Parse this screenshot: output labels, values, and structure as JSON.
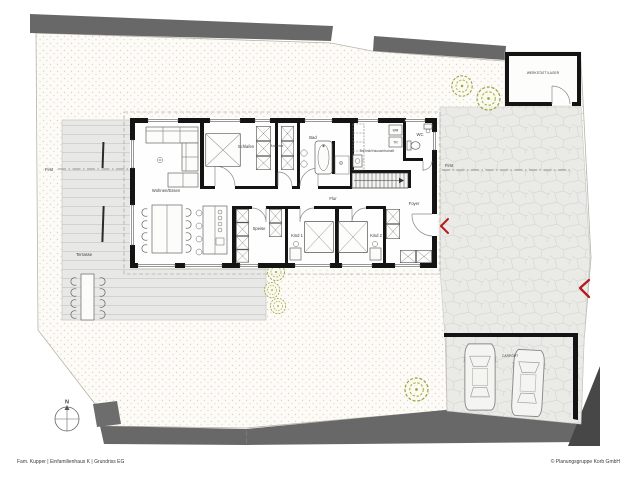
{
  "meta": {
    "footer_left": "Fam. Kupper | Einfamilienhaus K | Grundriss EG",
    "footer_right": "© Planungsgruppe Korb GmbH"
  },
  "site": {
    "compass": "N",
    "ridge_left": "First",
    "ridge_right": "First",
    "terrace": "Terrasse",
    "carport": "CARPORT",
    "workshop": "WERKSTATT/LAGER"
  },
  "rooms": {
    "living": "Wohnen/Essen",
    "bedroom": "Schlafen",
    "dressing": "Ankleide",
    "bath": "Bad",
    "utility": "Technik/Hauswirtschaft",
    "wc": "WC",
    "hall": "Flur",
    "foyer": "Foyer",
    "child1": "Kind 1",
    "child2": "Kind 2",
    "pantry": "Speise"
  },
  "appliances": {
    "washer": "WM",
    "dryer": "TR"
  },
  "colors": {
    "wall": "#141414",
    "road_gray": "#686868",
    "dark_wedge": "#474747",
    "accent_red": "#b5191c",
    "tree_green": "#96a43f",
    "terrace_gray": "#e8e8e6"
  }
}
